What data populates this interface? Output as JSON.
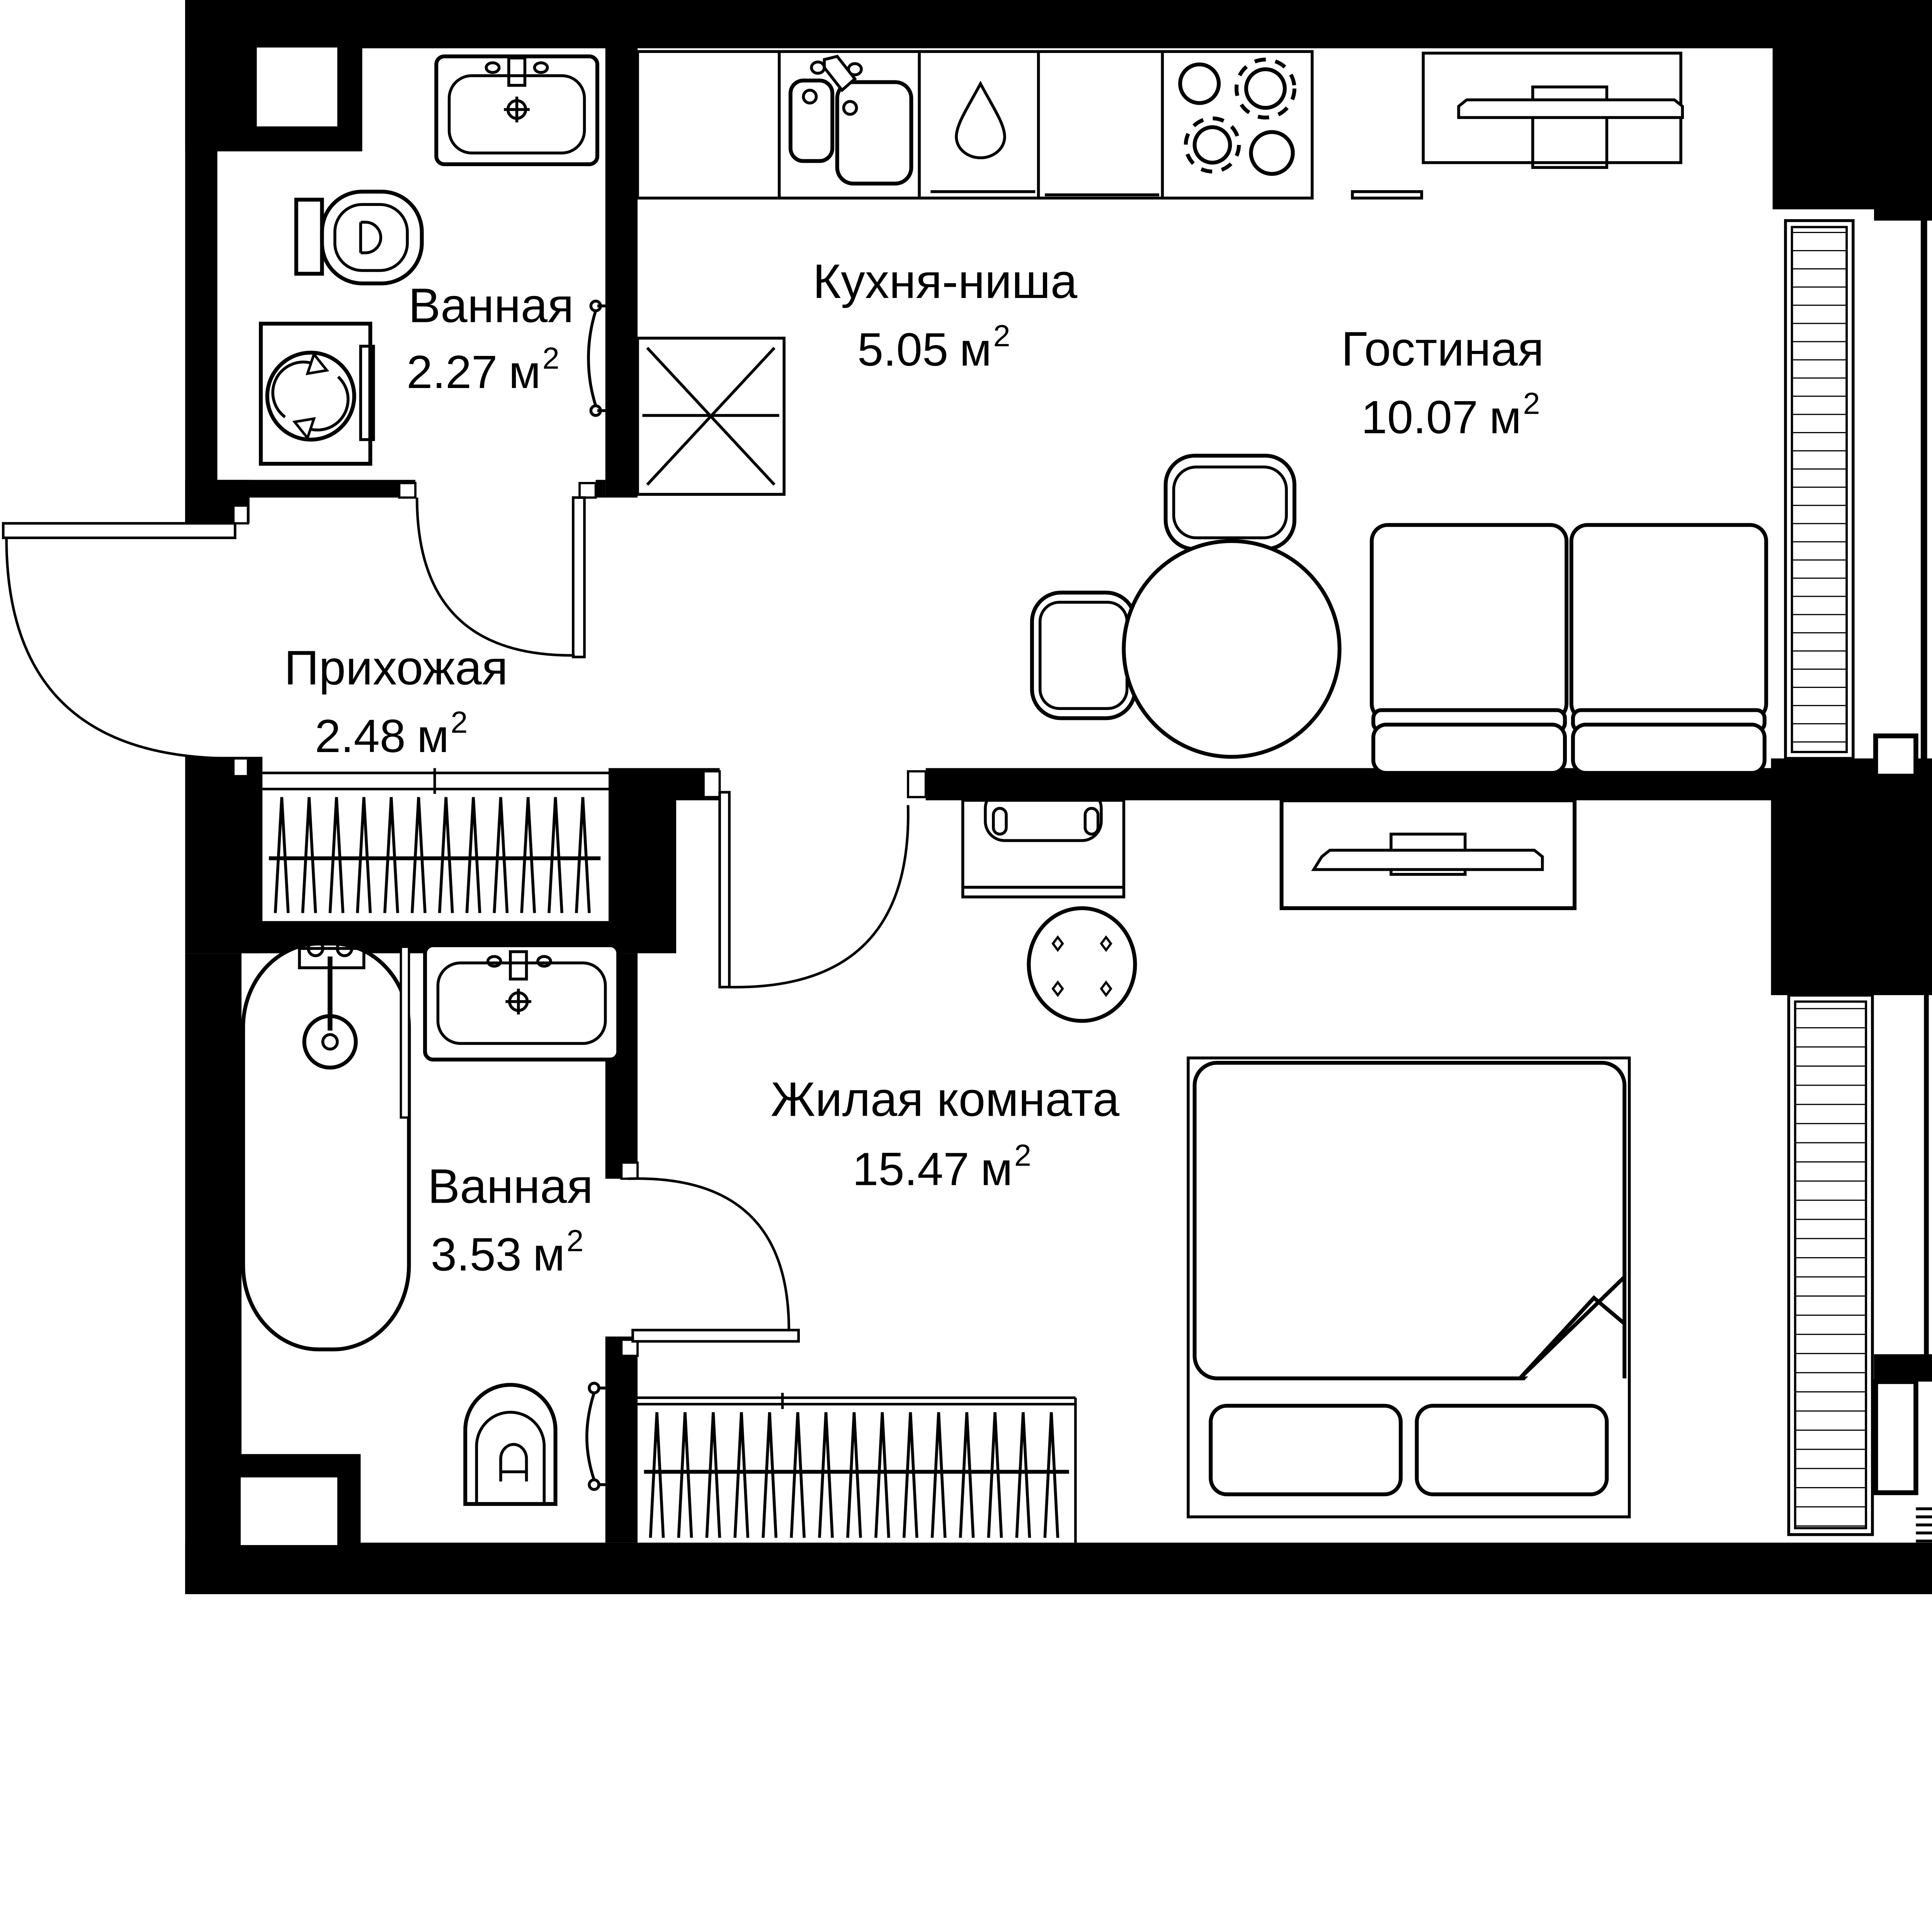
{
  "plan": {
    "rooms": [
      {
        "name": "Ванная",
        "area_value": "2.27",
        "area_unit": "м",
        "area_sup": "2"
      },
      {
        "name": "Кухня-ниша",
        "area_value": "5.05",
        "area_unit": "м",
        "area_sup": "2"
      },
      {
        "name": "Гостиная",
        "area_value": "10.07",
        "area_unit": "м",
        "area_sup": "2"
      },
      {
        "name": "Прихожая",
        "area_value": "2.48",
        "area_unit": "м",
        "area_sup": "2"
      },
      {
        "name": "Ванная",
        "area_value": "3.53",
        "area_unit": "м",
        "area_sup": "2"
      },
      {
        "name": "Жилая комната",
        "area_value": "15.47",
        "area_unit": "м",
        "area_sup": "2"
      }
    ],
    "colors": {
      "wall": "#000000",
      "floor": "#ffffff"
    }
  }
}
